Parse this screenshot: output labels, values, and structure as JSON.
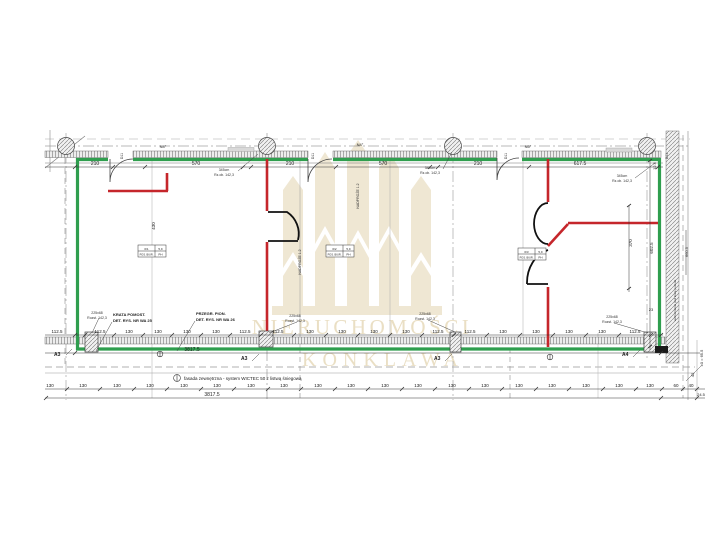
{
  "watermark": {
    "line1": "NIERUCHOMOŚCI",
    "line2": "KONKLAWA",
    "color": "#ece2cb"
  },
  "colors": {
    "wall_new_green": "#2f9e4e",
    "wall_demolition_red": "#c5262b",
    "wall_existing_black": "#111111",
    "line_gray": "#666666"
  },
  "dims": {
    "top": [
      "210",
      "570",
      "210",
      "570",
      "210",
      "617.5"
    ],
    "top_small": "12.5",
    "row1": [
      "112.5",
      "112.5",
      "130",
      "130",
      "130",
      "130",
      "112.5",
      "112.5",
      "130",
      "130",
      "130",
      "130",
      "112.5",
      "112.5",
      "130",
      "130",
      "130",
      "130",
      "112.5"
    ],
    "row1_total": "3817.5",
    "row2": [
      "130",
      "130",
      "130",
      "130",
      "130",
      "130",
      "130",
      "130",
      "130",
      "130",
      "130",
      "130",
      "130",
      "130",
      "130",
      "130",
      "130",
      "130",
      "130",
      "60",
      "40"
    ],
    "row2_total": "3817.5",
    "right_small": "24.5",
    "v_left": "430",
    "v_right1": "370",
    "v_right2": "602.5",
    "v_right3": "660.5",
    "small23": "23",
    "level": "±0 = 65.5",
    "level2": "42"
  },
  "grid": {
    "n1": "N4°",
    "n2": "N4°",
    "n3": "N5°",
    "d_tag": "D11"
  },
  "annotations": {
    "krata1": "KRATA POMOST.",
    "krata2": "DET. RYS. NR WA 25",
    "przegr1": "PRZEGR. PION.",
    "przegr2": "DET. RYS. NR WA 26",
    "fasada": "fasada zewnętrzna - system WICTEC 50 z listwą śniegową",
    "beam1": "345cm",
    "beam2": "Rz.ob. 142,3",
    "col1": "225x68",
    "col2": "Rozst. 142,3",
    "nadproze": "NADPROŻE 1.2",
    "wzmoc": "wzmocnienie pod kratę pomost."
  },
  "section_markers": {
    "a3": "A3",
    "a4": "A4"
  },
  "room_tags": [
    {
      "no": "0/1",
      "area": "5,9",
      "name": "POS. BIUR.",
      "type": "PH"
    },
    {
      "no": "0/2",
      "area": "5,9",
      "name": "POS. BIUR.",
      "type": "PH"
    },
    {
      "no": "0/3",
      "area": "5,9",
      "name": "POS. BIUR.",
      "type": "PH"
    }
  ]
}
